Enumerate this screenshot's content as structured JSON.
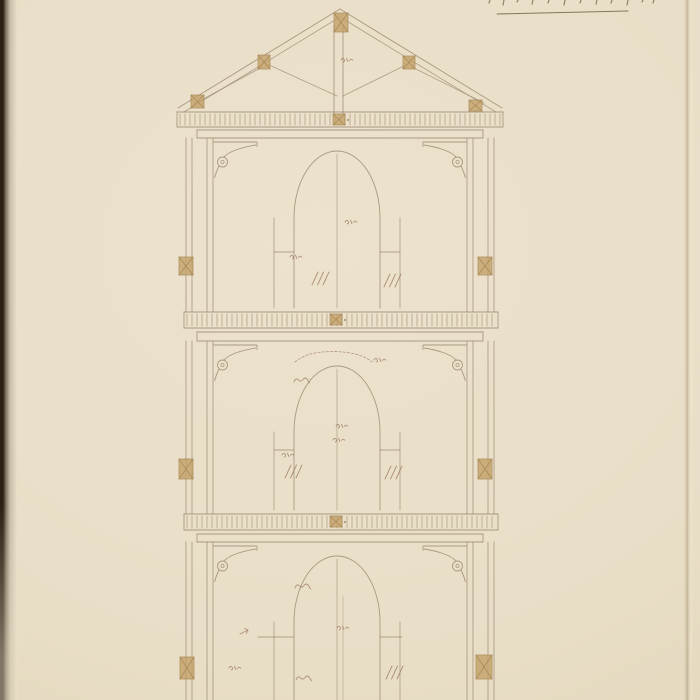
{
  "page": {
    "kind": "scanned architectural drawing: sectional elevation of a three-story tower with king-post roof truss",
    "canvas": {
      "width": 700,
      "height": 700
    },
    "colors": {
      "paper": "#eae0ca",
      "paper_edge": "#e2d5b8",
      "ink": "#a4907a",
      "ink_dark": "#8f7b62",
      "dentil": "#9a8768",
      "ochre": "#c5a36c",
      "ochre_dark": "#a3824e",
      "annotation": "#96705a",
      "binding": "#2b2012",
      "fold": "#8f7a58",
      "inscription_ink": "#6e5b3f"
    }
  },
  "inscription": {
    "note": "handwritten caption cut off at top edge; only letter bottoms and an underline are visible",
    "underline": {
      "x1": 497,
      "y1": 14,
      "x2": 628,
      "y2": 11
    },
    "ticks": [
      [
        490,
        3
      ],
      [
        504,
        5
      ],
      [
        518,
        2
      ],
      [
        533,
        4
      ],
      [
        549,
        3
      ],
      [
        565,
        5
      ],
      [
        581,
        3
      ],
      [
        597,
        4
      ],
      [
        612,
        3
      ],
      [
        628,
        5
      ],
      [
        643,
        2
      ],
      [
        654,
        3
      ]
    ]
  },
  "drawing": {
    "center_x": 337,
    "roof": {
      "apex": [
        340,
        9
      ],
      "eave_left": [
        178,
        108
      ],
      "eave_right": [
        502,
        108
      ],
      "rafter_gap": 8,
      "king_post": {
        "x1": 334,
        "x2": 343,
        "top": 26,
        "bottom": 114
      },
      "struts": [
        [
          337,
          96,
          267,
          64
        ],
        [
          343,
          96,
          408,
          64
        ],
        [
          196,
          103,
          262,
          67
        ],
        [
          484,
          103,
          412,
          67
        ]
      ],
      "joints": [
        [
          334,
          13,
          14,
          19
        ],
        [
          258,
          55,
          12,
          14
        ],
        [
          403,
          56,
          12,
          13
        ],
        [
          191,
          95,
          13,
          13
        ],
        [
          469,
          100,
          13,
          11
        ]
      ]
    },
    "cornice": {
      "x1": 177,
      "x2": 503,
      "dentil_top": 114,
      "dentil_bottom": 125
    },
    "walls": {
      "verticals": [
        186,
        192,
        207,
        213,
        467,
        473,
        488,
        494
      ]
    },
    "bracket": {
      "width": 44,
      "left_x": 213,
      "right_x": 467
    },
    "arch": {
      "half_width": 43,
      "reveal_half": 63
    },
    "band_x": [
      197,
      483
    ],
    "stories": [
      {
        "name": "story-1",
        "band": [
          130,
          138
        ],
        "top": 138,
        "bottom": 312,
        "bracket_y": 141,
        "arch": {
          "crown": 151,
          "spring": 218,
          "bottom": 308
        },
        "impost": {
          "y": 252,
          "l": [
            274,
            294
          ],
          "r": [
            380,
            400
          ]
        },
        "center_pair": false
      },
      {
        "name": "story-2",
        "band": [
          332,
          341
        ],
        "top": 341,
        "bottom": 514,
        "bracket_y": 344,
        "arch": {
          "crown": 366,
          "spring": 432,
          "bottom": 510
        },
        "impost": {
          "y": 450,
          "l": [
            274,
            294
          ],
          "r": [
            380,
            400
          ]
        },
        "center_pair": false
      },
      {
        "name": "story-3",
        "band": [
          534,
          542
        ],
        "top": 542,
        "bottom": 700,
        "bracket_y": 545,
        "arch": {
          "crown": 556,
          "spring": 622,
          "bottom": 700
        },
        "impost": {
          "y": 637,
          "l": [
            258,
            294
          ],
          "r": [
            380,
            402
          ]
        },
        "center_pair": true
      }
    ],
    "floor_bands": [
      {
        "x1": 184,
        "x2": 498,
        "dentil_top": 314,
        "dentil_bottom": 326
      },
      {
        "x1": 184,
        "x2": 498,
        "dentil_top": 516,
        "dentil_bottom": 528
      }
    ],
    "band_marks": [
      [
        333,
        114
      ],
      [
        330,
        314
      ],
      [
        330,
        516
      ]
    ],
    "wall_blocks": [
      [
        179,
        257,
        14,
        18
      ],
      [
        478,
        257,
        14,
        18
      ],
      [
        179,
        459,
        14,
        20
      ],
      [
        478,
        459,
        14,
        20
      ],
      [
        180,
        657,
        14,
        22
      ],
      [
        476,
        655,
        16,
        24
      ]
    ],
    "annotations": [
      {
        "t": "fig",
        "x": 341,
        "y": 60
      },
      {
        "t": "fig",
        "x": 345,
        "y": 222
      },
      {
        "t": "fig",
        "x": 290,
        "y": 257
      },
      {
        "t": "hatch",
        "x": 312,
        "y": 272
      },
      {
        "t": "hatch",
        "x": 384,
        "y": 274
      },
      {
        "t": "arcnote",
        "x": 295,
        "y": 352
      },
      {
        "t": "fig",
        "x": 374,
        "y": 360
      },
      {
        "t": "scrib",
        "x": 294,
        "y": 380
      },
      {
        "t": "fig",
        "x": 336,
        "y": 426
      },
      {
        "t": "fig",
        "x": 333,
        "y": 440
      },
      {
        "t": "fig",
        "x": 282,
        "y": 455
      },
      {
        "t": "hatch",
        "x": 285,
        "y": 465
      },
      {
        "t": "hatch",
        "x": 385,
        "y": 466
      },
      {
        "t": "scrib",
        "x": 295,
        "y": 586
      },
      {
        "t": "fig",
        "x": 337,
        "y": 628
      },
      {
        "t": "tick",
        "x": 240,
        "y": 632
      },
      {
        "t": "fig",
        "x": 229,
        "y": 668
      },
      {
        "t": "scrib",
        "x": 296,
        "y": 678
      },
      {
        "t": "hatch",
        "x": 386,
        "y": 666
      }
    ]
  }
}
